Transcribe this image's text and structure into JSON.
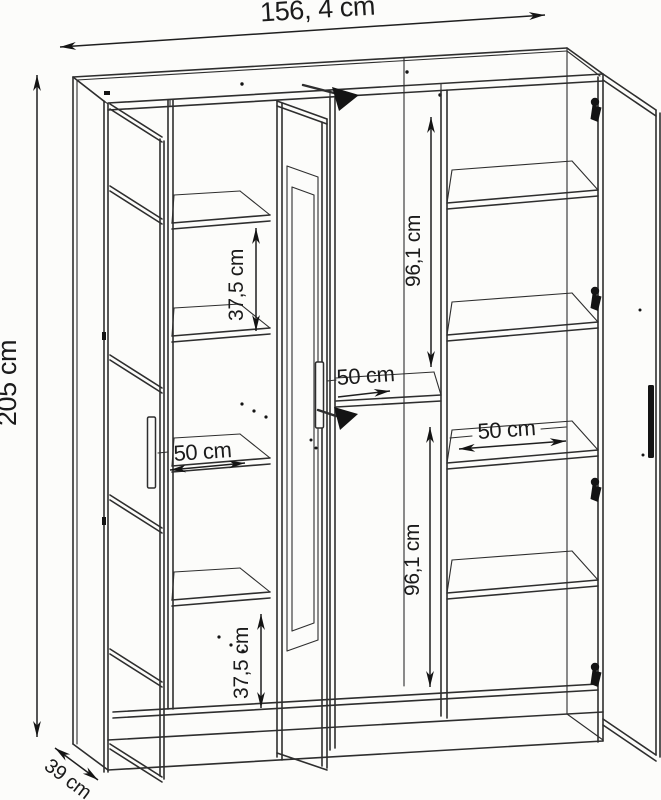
{
  "drawing": {
    "subject": "three-door wardrobe technical drawing",
    "colors": {
      "background": "#fcfcfa",
      "line": "#2e2e2e",
      "label": "#1b1b1b"
    }
  },
  "dimensions": {
    "overall_width": "156, 4 cm",
    "overall_height": "205 cm",
    "overall_depth": "39 cm",
    "left_shelf_gap_upper": "37,5 cm",
    "left_shelf_gap_lower": "37,5 cm",
    "hanging_space_upper": "96,1 cm",
    "hanging_space_lower": "96,1 cm",
    "shelf_width_left": "50 cm",
    "shelf_width_middle": "50 cm",
    "shelf_width_right": "50 cm"
  }
}
